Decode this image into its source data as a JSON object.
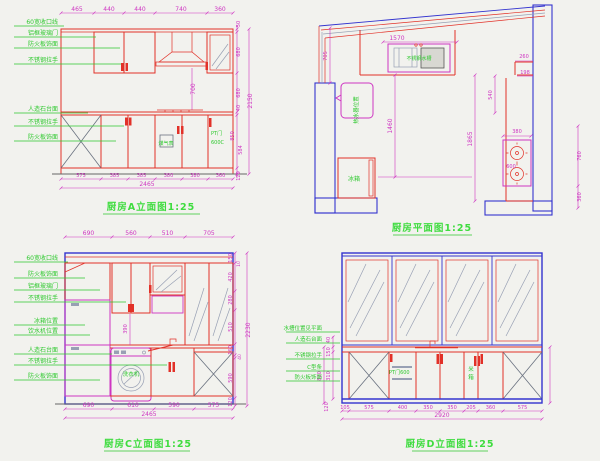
{
  "colors": {
    "cabinet_red": "#e23128",
    "dim_magenta": "#cf35c2",
    "label_green": "#2fc92f",
    "wall_blue": "#3434cf",
    "hatch_gray": "#98a0b4"
  },
  "panels": {
    "a": {
      "caption": "厨房A立面图1:25",
      "top_dims": [
        "465",
        "440",
        "440",
        "740",
        "360"
      ],
      "bottom_dims": [
        "575",
        "385",
        "385",
        "380",
        "380",
        "360"
      ],
      "total_width": "2465",
      "right_dims": [
        "50",
        "680",
        "680",
        "40",
        "850",
        "584",
        "120"
      ],
      "total_height": "2150",
      "hood_dim": "700",
      "labels": [
        "60宽收口线",
        "铝框玻璃门",
        "防火板饰面",
        "不锈钢拉手",
        "人造石台面",
        "不锈钢拉手",
        "防火板饰面"
      ],
      "gas_meter": "煤气表",
      "pt_line1": "PT门",
      "pt_line2": "600C"
    },
    "plan": {
      "caption": "厨房平面图1:25",
      "dims": {
        "sink_w": "1570",
        "left": "705",
        "left_mid": "1460",
        "right_mid": "1865",
        "upper_right": "540",
        "nook_a": "260",
        "nook_b": "198",
        "stove_w": "380",
        "stove_c": "600",
        "wall_a": "760",
        "wall_b": "360"
      },
      "sink_label": "不锈钢水槽",
      "heater_label": "热水器位置",
      "fridge_label": "冰箱"
    },
    "c": {
      "caption": "厨房C立面图1:25",
      "top_dims": [
        "690",
        "560",
        "510",
        "705"
      ],
      "bottom_dims": [
        "690",
        "610",
        "590",
        "575"
      ],
      "total_width": "2465",
      "right_dims": [
        "150",
        "10",
        "420",
        "280",
        "510",
        "160",
        "40",
        "590",
        "120"
      ],
      "total_height": "2230",
      "mid_dim": "390",
      "labels": [
        "60宽收口线",
        "防火板饰面",
        "铝框玻璃门",
        "不锈钢拉手",
        "冰箱位置",
        "饮水机位置",
        "人造石台面",
        "不锈钢拉手",
        "防火板饰面"
      ],
      "washer_label": "洗衣机"
    },
    "d": {
      "caption": "厨房D立面图1:25",
      "bottom_dims": [
        "105",
        "575",
        "400",
        "350",
        "350",
        "205",
        "360",
        "575"
      ],
      "total_width": "2920",
      "left_dims": [
        "40",
        "150",
        "310",
        "820",
        "120"
      ],
      "labels": [
        "水槽位置见平面",
        "人造石台面",
        "不锈钢拉手",
        "C型条",
        "防火板饰面"
      ],
      "pt_label": "PT门600",
      "rice1": "米",
      "rice2": "箱"
    }
  }
}
